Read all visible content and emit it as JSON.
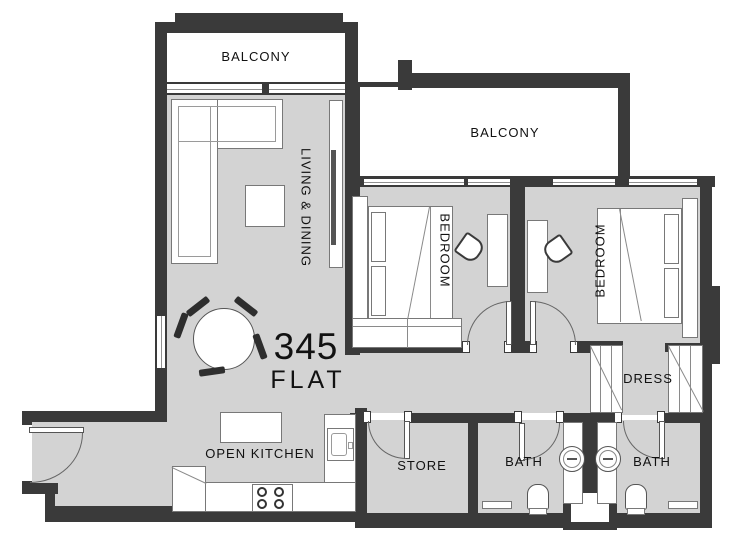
{
  "plan": {
    "flat_number": "345",
    "flat_type_label": "FLAT",
    "rooms": {
      "balcony_top": "BALCONY",
      "balcony_right": "BALCONY",
      "living_dining": "LIVING & DINING",
      "bedroom_left": "BEDROOM",
      "bedroom_right": "BEDROOM",
      "open_kitchen": "OPEN KITCHEN",
      "store": "STORE",
      "bath_left": "BATH",
      "bath_right": "BATH",
      "dress": "DRESS"
    },
    "colors": {
      "wall": "#3a3a3a",
      "floor": "#d3d3d3",
      "furniture_outline": "#787878",
      "label_text": "#111111",
      "balcony_floor": "#ffffff"
    }
  }
}
